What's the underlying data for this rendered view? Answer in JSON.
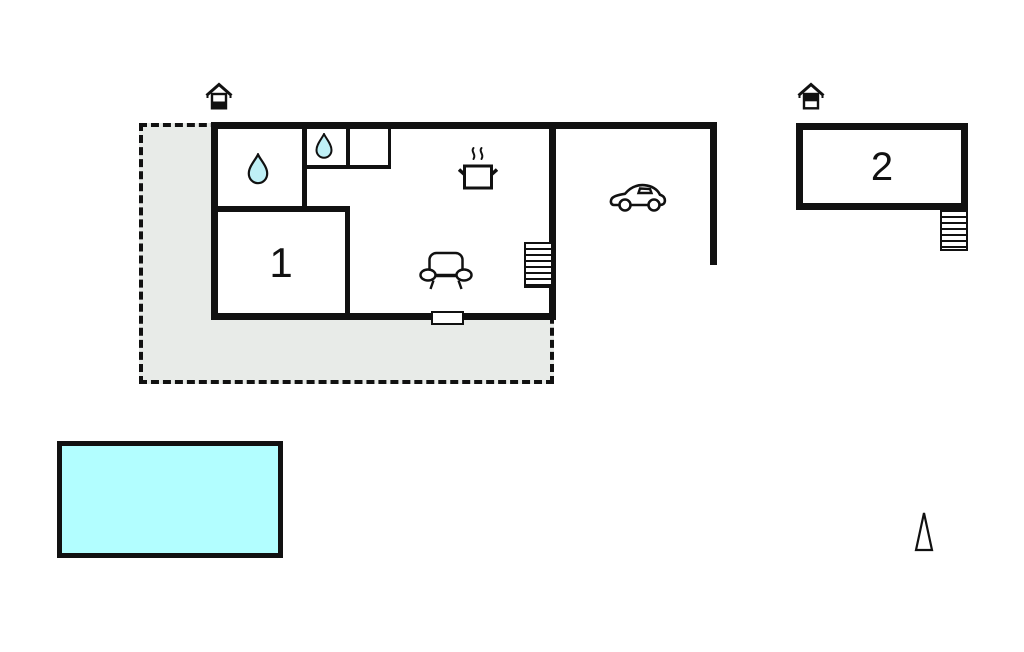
{
  "labels": {
    "room1": "1",
    "room2": "2"
  },
  "colors": {
    "line": "#111111",
    "terrace_fill": "#e8ebe8",
    "pool_fill": "#b2feff",
    "water_drop_fill": "#bff0f6",
    "background": "#ffffff"
  },
  "icons": {
    "entrance_main": "house-entrance-marker (black lower half)",
    "entrance_annex": "house-entrance-marker (black upper half)",
    "bathroom_large": "water-drop",
    "bathroom_small": "water-drop",
    "kitchen": "cooking-pot-with-steam",
    "living_area": "sofa",
    "carport": "car",
    "stairs_main": "staircase (7 treads)",
    "stairs_annex": "staircase (6 treads)",
    "bottom_wall": "window-opening",
    "compass": "north-arrow-triangle"
  },
  "areas": {
    "terrace": "dashed plot / terrace area",
    "main_building": "house with bathroom, wc, room 1, kitchen and living area",
    "carport": "open carport with car",
    "annex": "building 2 with external stairs",
    "pool": "swimming pool"
  }
}
